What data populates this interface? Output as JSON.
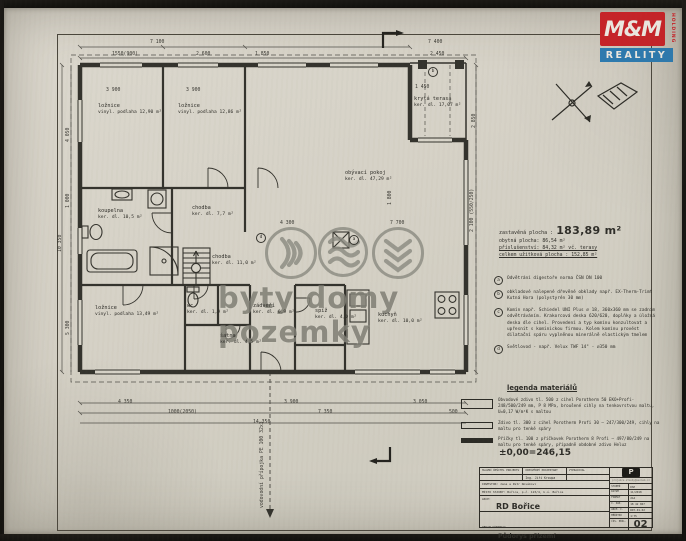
{
  "logo": {
    "mm": "M&M",
    "reality": "REALITY",
    "holding": "HOLDING"
  },
  "watermark": {
    "text": "byty domy pozemky"
  },
  "areas": {
    "line1_label": "zastavěná plocha :",
    "line1_value": "183,89 m²",
    "line2": "obytná plocha: 86,54 m²",
    "line3": "příslušenství: 84,32 m² vč. terasy",
    "line4": "celkem užitková plocha : 152,85 m²"
  },
  "notes": [
    {
      "k": "a",
      "text": "Odvětrání digestoře norma ČSN DN 100"
    },
    {
      "k": "b",
      "text": "obkladové nalepené dřevěné obklady např. EX-Therm-Trimt Kutná Hora (polystyrén 30 mm)"
    },
    {
      "k": "c",
      "text": "Komín např. Schiedel UNI Plus ⌀ 18, 360x360 mm se zadním odvětráváním. Krakorcová deska 620/620, doplňky a úložná deska dle cihel. Provedení a typ komínu konzultovat a upřesnit s kominickou firmou. Kolem komínu provést dilatační spáru vyplněnou minerálně elastickým tmelem"
    },
    {
      "k": "d",
      "text": "Světlovod - např. Velux TWF 14\" - ⌀350 mm"
    }
  ],
  "legend": {
    "title": "legenda materiálů",
    "items": [
      {
        "cls": "sym-500",
        "text": "Obvodové zdivo tl. 500 z cihel Porotherm 50 EKO+Profi-248/500/249 mm, P 8 MPa, broušené cihly na tenkovrstvou maltu, U=0,17 W/m²K s maltou"
      },
      {
        "cls": "sym-300",
        "text": "Zdivo tl. 300 z cihel Porotherm Profi 30 – 247/300/249, cihly na maltu pro tenké spáry"
      },
      {
        "cls": "sym-100",
        "text": "Příčky tl. 100 z příčkovek Porotherm 8 Profi – 497/80/249 na maltu pro tenké spáry, případně obdobné zdivo Heluz"
      }
    ],
    "level": "±0,00=246,15"
  },
  "titleblock": {
    "col1": "HLAVNÍ ŘEŠITEL PROJEKTU",
    "col2": "ODPOVĚDNÝ PROJEKTANT",
    "col3": "VYPRACOVAL",
    "designer": "Ing. Jiří Kroupa",
    "investor": "INVESTOR: Jana a Petr Novákovi",
    "place": "MÍSTO STAVBY: Bořice, p.č. 123/4, k.ú. Bořice",
    "akce_label": "AKCE:",
    "akce": "RD Bořice",
    "content_label": "OBSAH VÝKRESU:",
    "content": "Půdorys přízemí",
    "pmark": "P",
    "mail": "projekce.stavby@seznam.cz",
    "meta": [
      {
        "label": "STUPEŇ",
        "value": "DSP"
      },
      {
        "label": "DATUM",
        "value": "11/2018"
      },
      {
        "label": "FORMÁT",
        "value": "2A4"
      },
      {
        "label": "Č. ZAK.",
        "value": "18 42 067"
      },
      {
        "label": "ARCH. Č.",
        "value": "RD7-01-02"
      },
      {
        "label": "MĚŘÍTKO",
        "value": "1:75"
      }
    ],
    "sheet_label": "ČÍS. PŘÍL.",
    "sheet_number": "02"
  },
  "plan": {
    "rooms": [
      {
        "name": "ložnice",
        "area": "vinyl. podlaha 12,90 m²",
        "x": 98,
        "y": 103
      },
      {
        "name": "ložnice",
        "area": "vinyl. podlaha 12,86 m²",
        "x": 178,
        "y": 103
      },
      {
        "name": "krytá terasa",
        "area": "ker. dl. 17,07 m²",
        "x": 414,
        "y": 96
      },
      {
        "name": "koupelna",
        "area": "ker. dl. 10,5 m²",
        "x": 98,
        "y": 208
      },
      {
        "name": "chodba",
        "area": "ker. dl. 7,7 m²",
        "x": 192,
        "y": 205
      },
      {
        "name": "chodba",
        "area": "ker. dl. 11,0 m²",
        "x": 212,
        "y": 254
      },
      {
        "name": "obývací pokoj",
        "area": "ker. dl. 47,29 m²",
        "x": 345,
        "y": 170
      },
      {
        "name": "ložnice",
        "area": "vinyl. podlaha 13,49 m²",
        "x": 95,
        "y": 305
      },
      {
        "name": "wc",
        "area": "ker. dl. 1,9 m²",
        "x": 187,
        "y": 303
      },
      {
        "name": "šatna",
        "area": "ker. dl. 4,5 m²",
        "x": 220,
        "y": 333
      },
      {
        "name": "zádveří",
        "area": "ker. dl. 6,9 m²",
        "x": 253,
        "y": 303
      },
      {
        "name": "spíž",
        "area": "ker. dl. 4,0 m²",
        "x": 315,
        "y": 308
      },
      {
        "name": "kuchyň",
        "area": "ker. dl. 10,0 m²",
        "x": 378,
        "y": 312
      }
    ],
    "dimensions": [
      {
        "t": "7 100",
        "x": 150,
        "y": 40
      },
      {
        "t": "1550(900)",
        "x": 112,
        "y": 52
      },
      {
        "t": "2 600",
        "x": 196,
        "y": 52
      },
      {
        "t": "1 850",
        "x": 255,
        "y": 52
      },
      {
        "t": "7 400",
        "x": 428,
        "y": 40
      },
      {
        "t": "2 450",
        "x": 430,
        "y": 52
      },
      {
        "t": "1 450",
        "x": 415,
        "y": 85
      },
      {
        "t": "3 900",
        "x": 106,
        "y": 88
      },
      {
        "t": "3 900",
        "x": 186,
        "y": 88
      },
      {
        "t": "4 300",
        "x": 280,
        "y": 221
      },
      {
        "t": "7 700",
        "x": 390,
        "y": 221
      },
      {
        "t": "4 350",
        "x": 118,
        "y": 400
      },
      {
        "t": "1000(2050)",
        "x": 168,
        "y": 410
      },
      {
        "t": "3 900",
        "x": 284,
        "y": 400
      },
      {
        "t": "7 350",
        "x": 318,
        "y": 410
      },
      {
        "t": "3 050",
        "x": 413,
        "y": 400
      },
      {
        "t": "500",
        "x": 449,
        "y": 410
      },
      {
        "t": "14 350",
        "x": 253,
        "y": 420
      },
      {
        "t": "10 350",
        "x": 58,
        "y": 252,
        "rot": -90
      },
      {
        "t": "4 050",
        "x": 66,
        "y": 142,
        "rot": -90
      },
      {
        "t": "1 000",
        "x": 66,
        "y": 208,
        "rot": -90
      },
      {
        "t": "5 300",
        "x": 66,
        "y": 335,
        "rot": -90
      },
      {
        "t": "1 800",
        "x": 388,
        "y": 205,
        "rot": -90
      },
      {
        "t": "2 100 (550/250)",
        "x": 470,
        "y": 232,
        "rot": -90
      },
      {
        "t": "2 850",
        "x": 472,
        "y": 128,
        "rot": -90
      },
      {
        "t": "vodovodní přípojka PE 100 32x3",
        "x": 260,
        "y": 508,
        "rot": -90
      }
    ],
    "marks": [
      {
        "k": "d",
        "x": 256,
        "y": 233
      },
      {
        "k": "a",
        "x": 349,
        "y": 235
      },
      {
        "k": "b",
        "x": 428,
        "y": 67
      }
    ]
  }
}
